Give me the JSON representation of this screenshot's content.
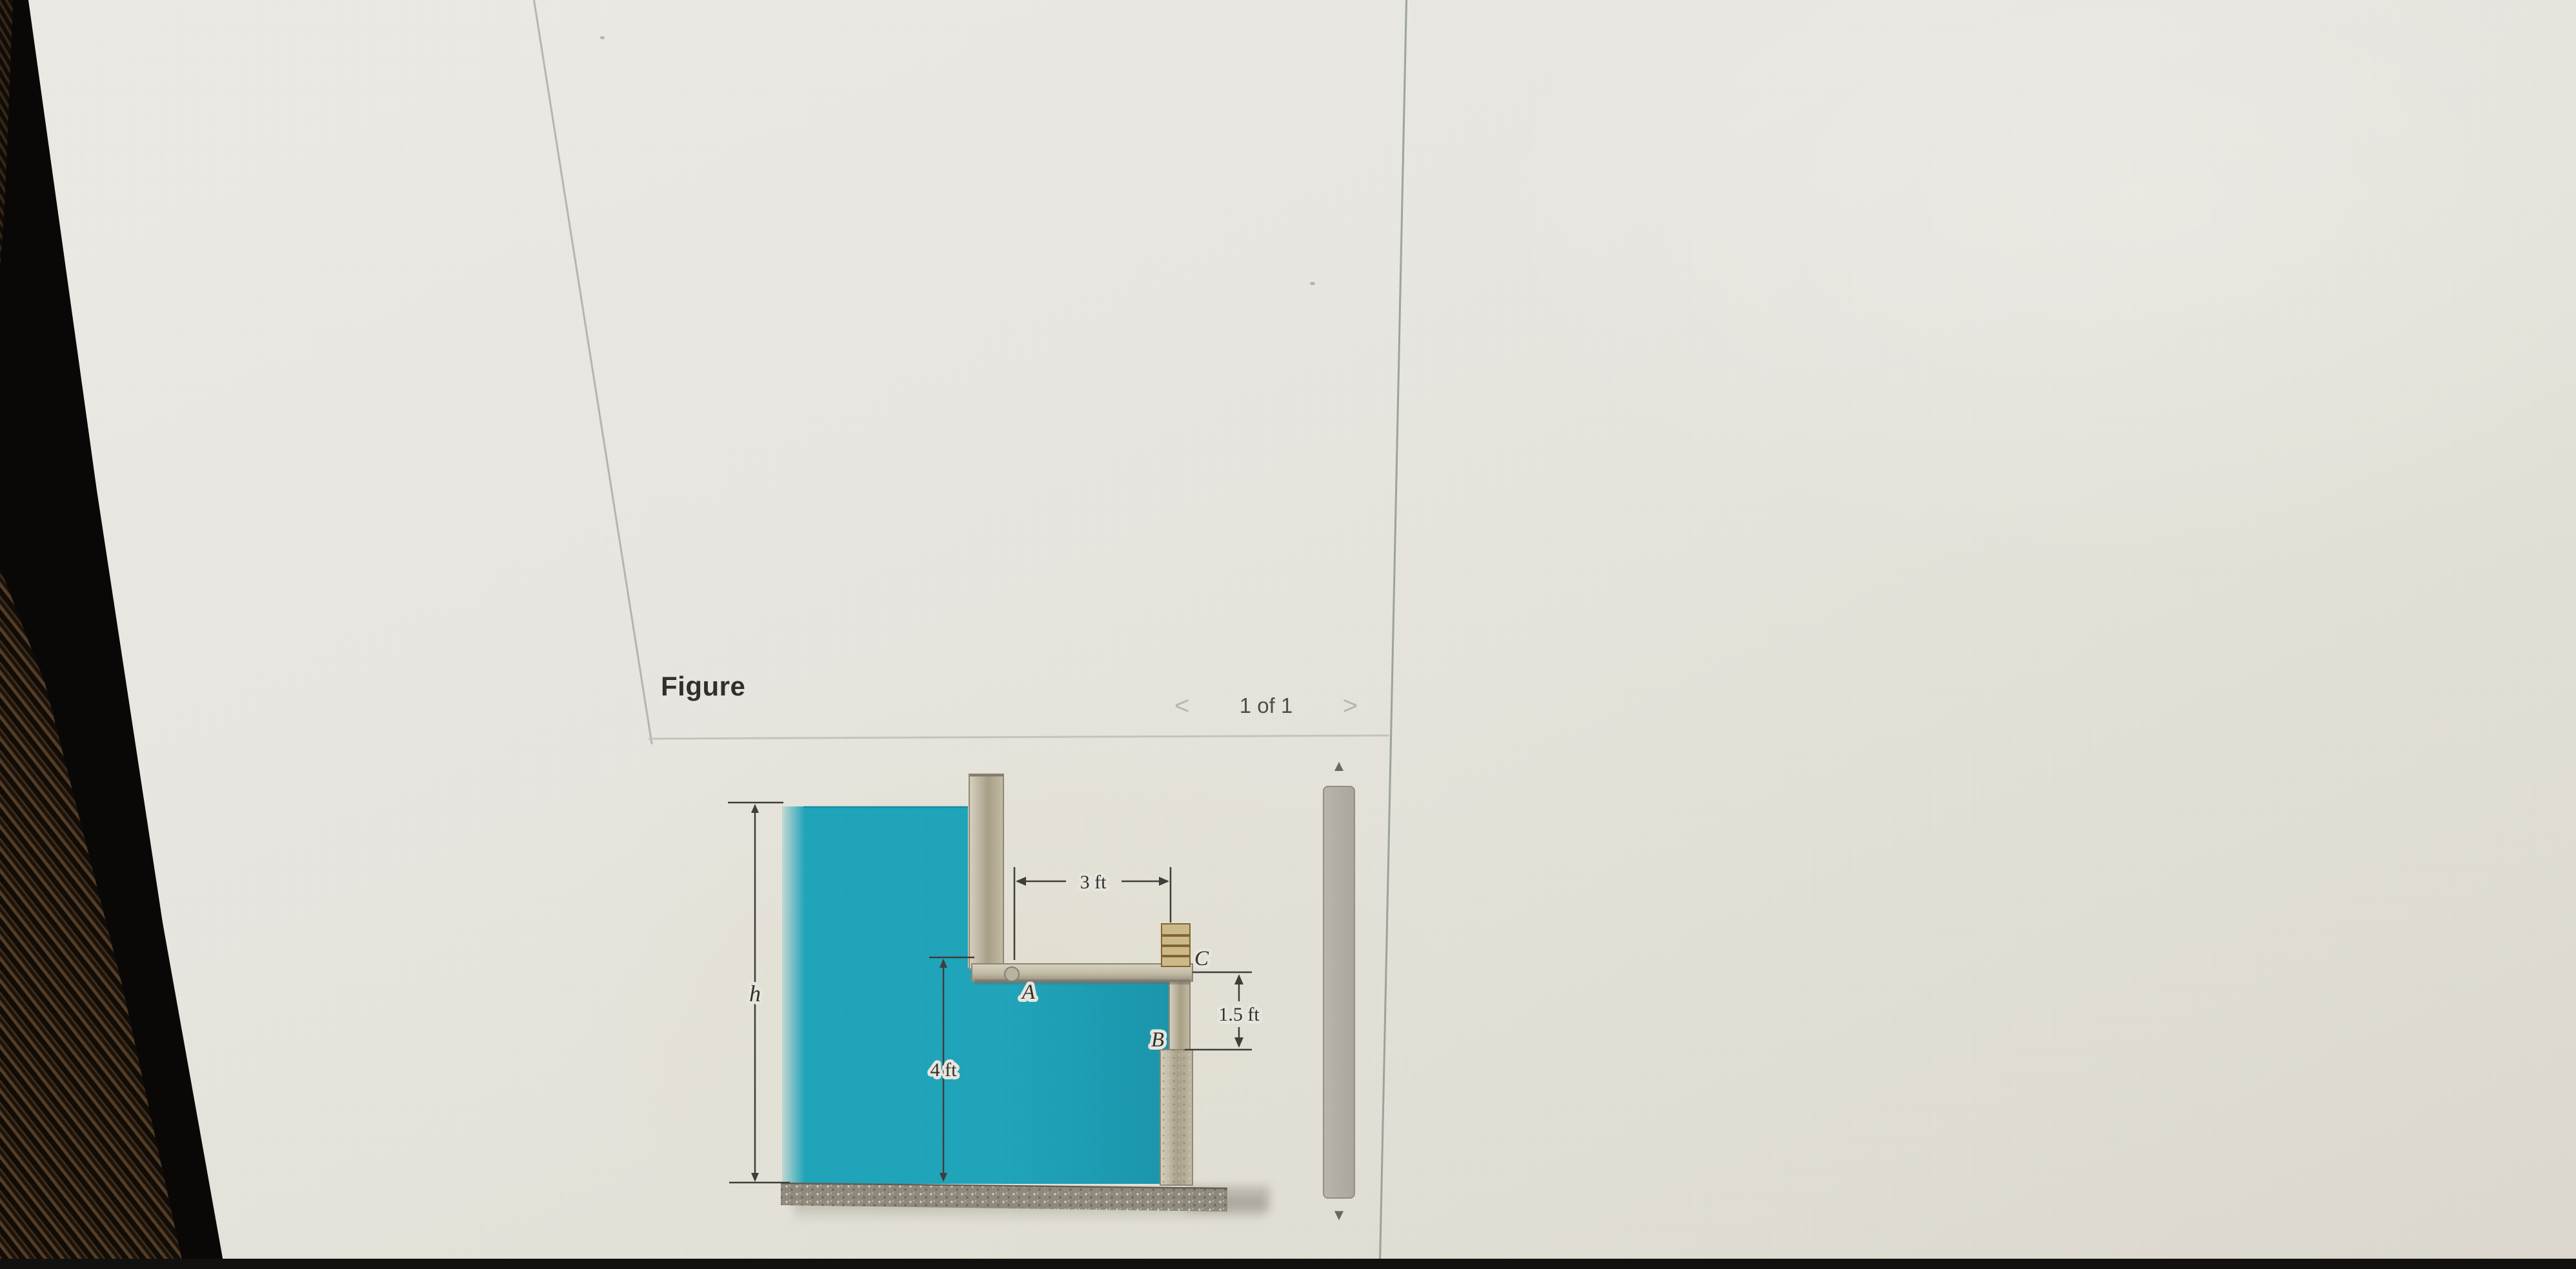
{
  "figure_panel": {
    "title": "Figure",
    "pagination": {
      "prev_icon": "<",
      "current": "1 of 1",
      "next_icon": ">"
    }
  },
  "diagram": {
    "labels": {
      "h": "h",
      "four_ft": "4 ft",
      "three_ft": "3 ft",
      "one_five_ft": "1.5 ft",
      "A": "A",
      "B": "B",
      "C": "C"
    }
  },
  "scrollbar": {
    "up_icon": "▲",
    "down_icon": "▼"
  },
  "colors": {
    "water": "#1ba3ba",
    "water-deep": "#1694ab",
    "water-edge": "#0e7f95",
    "wall-light": "#d8d2c0",
    "wall-dark": "#a89e85",
    "wall-mid": "#c3bba4",
    "block-tan": "#cdb987",
    "block-line": "#80622f",
    "base-gray": "#8e887b",
    "dim-line": "#3b3a35",
    "label-ink": "#2e2d28",
    "halo": "#e9e6de",
    "chevron": "#b7b5ad",
    "page-bg": "#e8e6e0"
  }
}
